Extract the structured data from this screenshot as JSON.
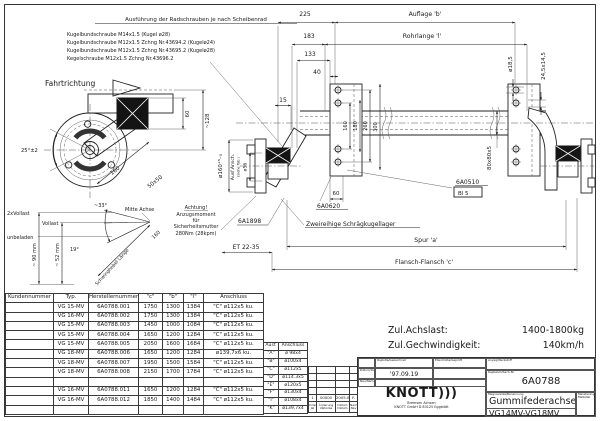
{
  "notes": {
    "header": "Ausführung der Radschrauben je nach Scheibenrad",
    "lines": [
      "Kugelbundschraube M14x1.5 (Kugel ø28)",
      "Kugelbundschraube M12x1.5 Zchng Nr.43694.2 (Kugelø24)",
      "Kugelbundschraube M12x1.5 Zchng Nr.43695.2 (Kugelø28)",
      "Kegelschraube M12x1.5 Zchng Nr.43696.2"
    ]
  },
  "labels": {
    "fahrtrichtung": "Fahrtrichtung",
    "d225": "225",
    "d183": "183",
    "d133": "133",
    "d40": "40",
    "d15": "15",
    "auflage": "Auflage 'b'",
    "rohrlange": "Rohrlange 'l'",
    "v160": "160",
    "v180": "180",
    "v260": "260",
    "v300": "300",
    "sq80": "80x80x5",
    "d18_5": "ø18,5",
    "d24_5": "24,5x14,5",
    "d160tol": "ø160⁺⁵₋₀",
    "ausf_ansch": "Ausf.Ansch.",
    "siehe_tab": "(siehe Tab.)",
    "d56": "ø56",
    "dim60": "60",
    "dim60_plate": "60",
    "dim128": "~128",
    "deg25": "25°±2",
    "len160_side": "160",
    "sq5050": "50x50",
    "zweivollast": "2xVollast",
    "vollast": "Vollast",
    "unbeladen": "unbeladen",
    "mm90": "~ 90 mm",
    "mm52": "~ 52 mm",
    "deg33": "~33°",
    "deg19": "19°",
    "mitte_achse": "Mitte Achse",
    "len160_lever": "160",
    "schwinghebel": "Schwinghebel Länge",
    "achtung": [
      "Achtung!",
      "Anzugsmoment",
      "für",
      "Sicherheitsmutter",
      "280Nm (28kpm)"
    ],
    "part_6a1898": "6A1898",
    "part_6a0620": "6A0620",
    "part_6a0510": "6A0510",
    "bl5": "Bl 5",
    "bearing": "Zweireihige Schrägkugellager",
    "et": "ET 22-35",
    "spur": "Spur 'a'",
    "flansch": "Flansch-Flansch 'c'"
  },
  "zul": {
    "achslast_label": "Zul.Achslast:",
    "achslast_value": "1400-1800kg",
    "speed_label": "Zul.Gechwindigkeit:",
    "speed_value": "140km/h"
  },
  "main_table": {
    "headers": [
      "Kundennummer",
      "Typ.",
      "Herstellernummer",
      "\"c\"",
      "\"b\"",
      "\"l\"",
      "Anschluss"
    ],
    "rows": [
      [
        "",
        "VG 15-MV",
        "6A0788.001",
        "1750",
        "1300",
        "1384",
        "\"C\" ø112x5 ku."
      ],
      [
        "",
        "VG 16-MV",
        "6A0788.002",
        "1750",
        "1300",
        "1384",
        "\"C\" ø112x5 ku."
      ],
      [
        "",
        "VG 15-MV",
        "6A0788.003",
        "1450",
        "1000",
        "1084",
        "\"C\" ø112x5 ku."
      ],
      [
        "",
        "VG 15-MV",
        "6A0788.004",
        "1650",
        "1200",
        "1284",
        "\"C\" ø112x5 ku."
      ],
      [
        "",
        "VG 15-MV",
        "6A0788.005",
        "2050",
        "1600",
        "1684",
        "\"C\" ø112x5 ku."
      ],
      [
        "",
        "VG 18-MV",
        "6A0788.006",
        "1650",
        "1200",
        "1284",
        "ø139,7x6 ku."
      ],
      [
        "",
        "VG 18-MV",
        "6A0788.007",
        "1950",
        "1500",
        "1584",
        "\"C\" ø112x5 ku."
      ],
      [
        "",
        "VG 18-MV",
        "6A0788.008",
        "2150",
        "1700",
        "1784",
        "\"C\" ø112x5 ku."
      ],
      [
        "",
        "",
        "",
        "",
        "",
        "",
        ""
      ],
      [
        "",
        "VG 16-MV",
        "6A0788.011",
        "1650",
        "1200",
        "1284",
        "\"C\" ø112x5 ku."
      ],
      [
        "",
        "VG 16-MV",
        "6A0788.012",
        "1850",
        "1400",
        "1484",
        "\"C\" ø112x5 ku."
      ],
      [
        "",
        "",
        "",
        "",
        "",
        "",
        ""
      ]
    ]
  },
  "ausf_table": {
    "headers": [
      "Ausf.",
      "Anschluss"
    ],
    "rows": [
      [
        "\"A\"",
        "ø 98x4"
      ],
      [
        "\"B\"",
        "ø100x4"
      ],
      [
        "\"C\"",
        "ø112x5"
      ],
      [
        "\"D\"",
        "ø114.3x5"
      ],
      [
        "\"E\"",
        "ø120x5"
      ],
      [
        "\"F\"",
        "ø130x4"
      ],
      [
        "\"I\"",
        "ø108x4"
      ],
      [
        "\"K\"",
        "ø139,7x4"
      ]
    ]
  },
  "revision": {
    "rows": [
      [
        "",
        "",
        "",
        ""
      ],
      [
        "",
        "",
        "",
        ""
      ],
      [
        "",
        "",
        "",
        ""
      ],
      [
        "",
        "",
        "",
        ""
      ],
      [
        "1",
        "00000",
        "2005.08.14",
        "F."
      ],
      [
        "Index\nJel",
        "Änderung\nVáltozás",
        "Datum\nDátum",
        "Name\nNév"
      ]
    ]
  },
  "titleblock": {
    "drawn_label": "Rajzolta/Gezeichnet",
    "checked_label": "Ellenőrizte/Geprüft",
    "date_label": "Dátum/Datum",
    "date_value": "'97.09.19",
    "name_label": "Név/Name",
    "material_label": "Anyag/Werkstoff",
    "number_label": "Rajzszám/Sach-Nr",
    "number_value": "6A0788",
    "title_label": "Megnevezés/Benennung",
    "title_value": "Gummifederachse",
    "subtitle_value": "VG14MV-VG18MV",
    "scale_label": "Méretarány\nMaßstab",
    "company": {
      "logo": "KNOTT",
      "logo_arcs": ")))",
      "tagline": "Bremsen      Achsen",
      "address": "KNOTT GmbH  D 83125  Eggstätt"
    }
  }
}
